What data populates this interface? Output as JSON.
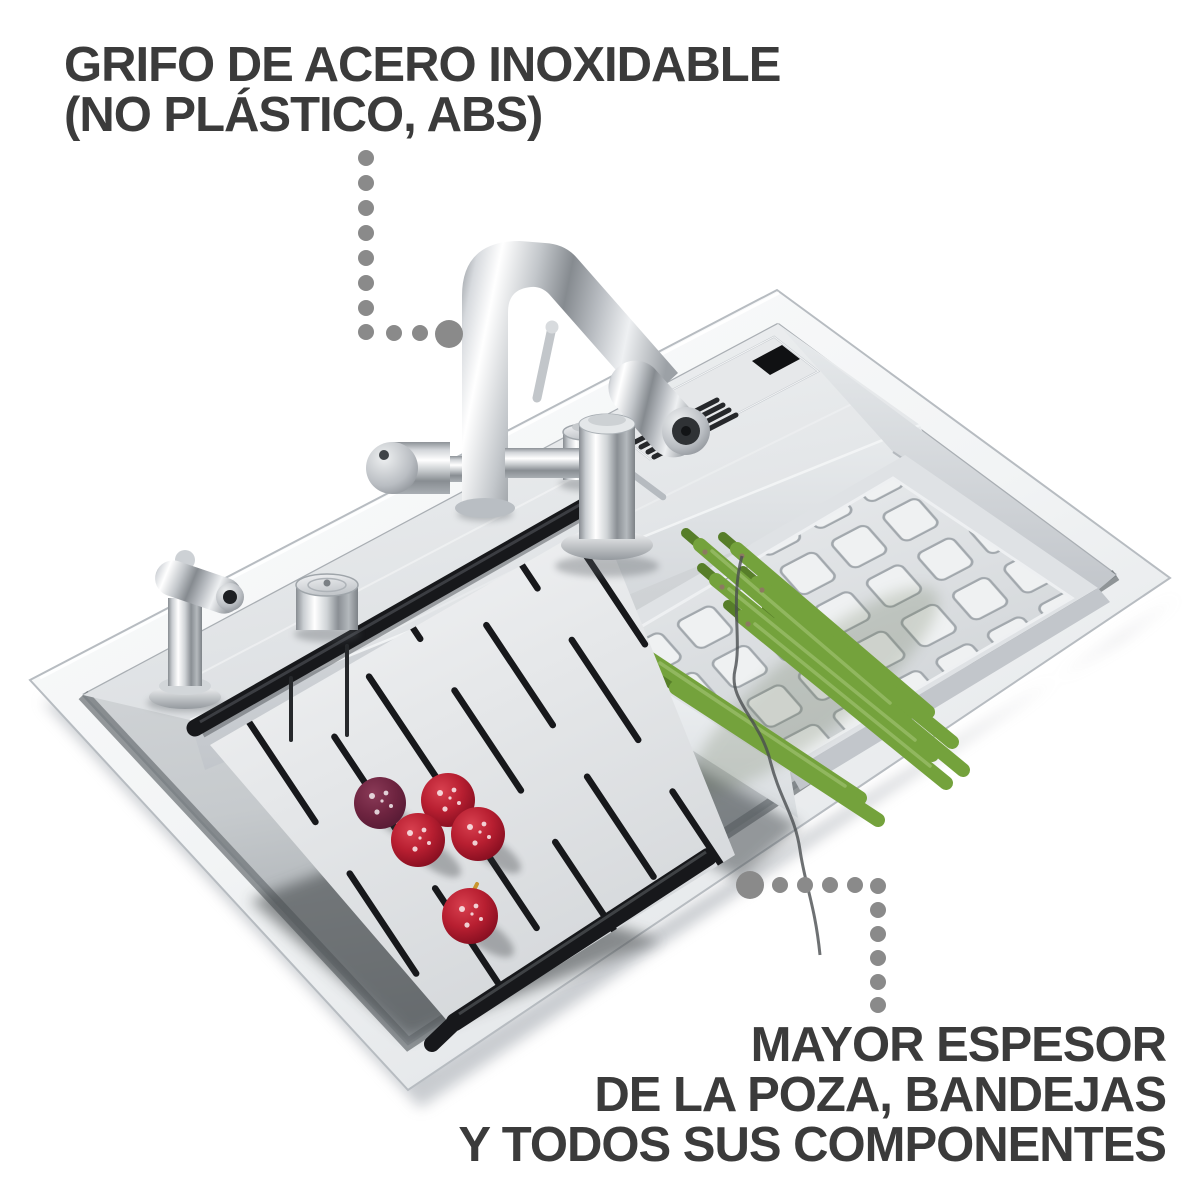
{
  "annotations": {
    "top": {
      "line1": "GRIFO DE ACERO INOXIDABLE",
      "line2": "(NO PLÁSTICO, ABS)"
    },
    "bottom": {
      "line1": "MAYOR ESPESOR",
      "line2": "DE LA POZA, BANDEJAS",
      "line3": "Y TODOS SUS COMPONENTES"
    }
  },
  "colors": {
    "background": "#ffffff",
    "text": "#3b3b3b",
    "dots": "#8a8a8a",
    "rail": "#17181b",
    "asparagus": "#74a23c",
    "asparagusDark": "#577e29",
    "berryRed": "#bb1f2f",
    "berryDark": "#6e2440",
    "steelBright": "#f6f8f9",
    "steelMid": "#d7dadd",
    "steelDeep": "#9aa0a5"
  }
}
